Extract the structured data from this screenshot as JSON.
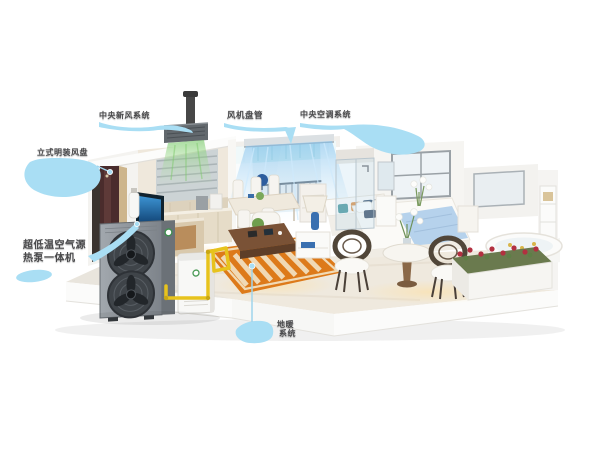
{
  "background_color": "#ffffff",
  "callout_style": {
    "accent_color": "#a9def4",
    "line_color": "#9fd4ec",
    "text_color": "#4a4a4c"
  },
  "callouts": {
    "fresh_air": {
      "text": "中央新风系统",
      "target": "ceiling-fresh-air-unit"
    },
    "fan_coil": {
      "text": "风机盘管",
      "target": "living-room-ceiling-outlet"
    },
    "central_ac": {
      "text": "中央空调系统",
      "target": "living-room-ceiling-outlet"
    },
    "floor_fan_coil": {
      "text": "立式明装风盘",
      "target": "vertical-fan-coil-cabinet"
    },
    "heat_pump": {
      "line1": "超低温空气源",
      "line2": "热泵一体机",
      "target": "outdoor-heat-pump-unit"
    },
    "floor_heating": {
      "line1": "地暖",
      "line2": "系统",
      "target": "floor-heating-coil-under-rug"
    }
  },
  "scene": {
    "description": "Isometric 3D cutaway of a home: kitchen with fresh-air ceiling unit (green airflow), living room with ceiling AC air curtains (blue), dining set, sofa and coffee table on orange rug with underfloor-heating loop, bedroom with blue duvet, shower, round table with rattan chairs, flower planter and bathtub; outside at left a grey twin-fan air-source heat pump with white hydronic module connected by a yellow pipe",
    "colors": {
      "heat_pump_body": "#8b9197",
      "pipe_yellow": "#e7c31d",
      "rug_orange": "#dd7a1a",
      "cool_air_blue": "#8cc6ef",
      "fresh_air_green": "#7cc96a",
      "duvet_blue": "#b6d2ec",
      "cabinet_brown": "#4a2c2c"
    }
  }
}
